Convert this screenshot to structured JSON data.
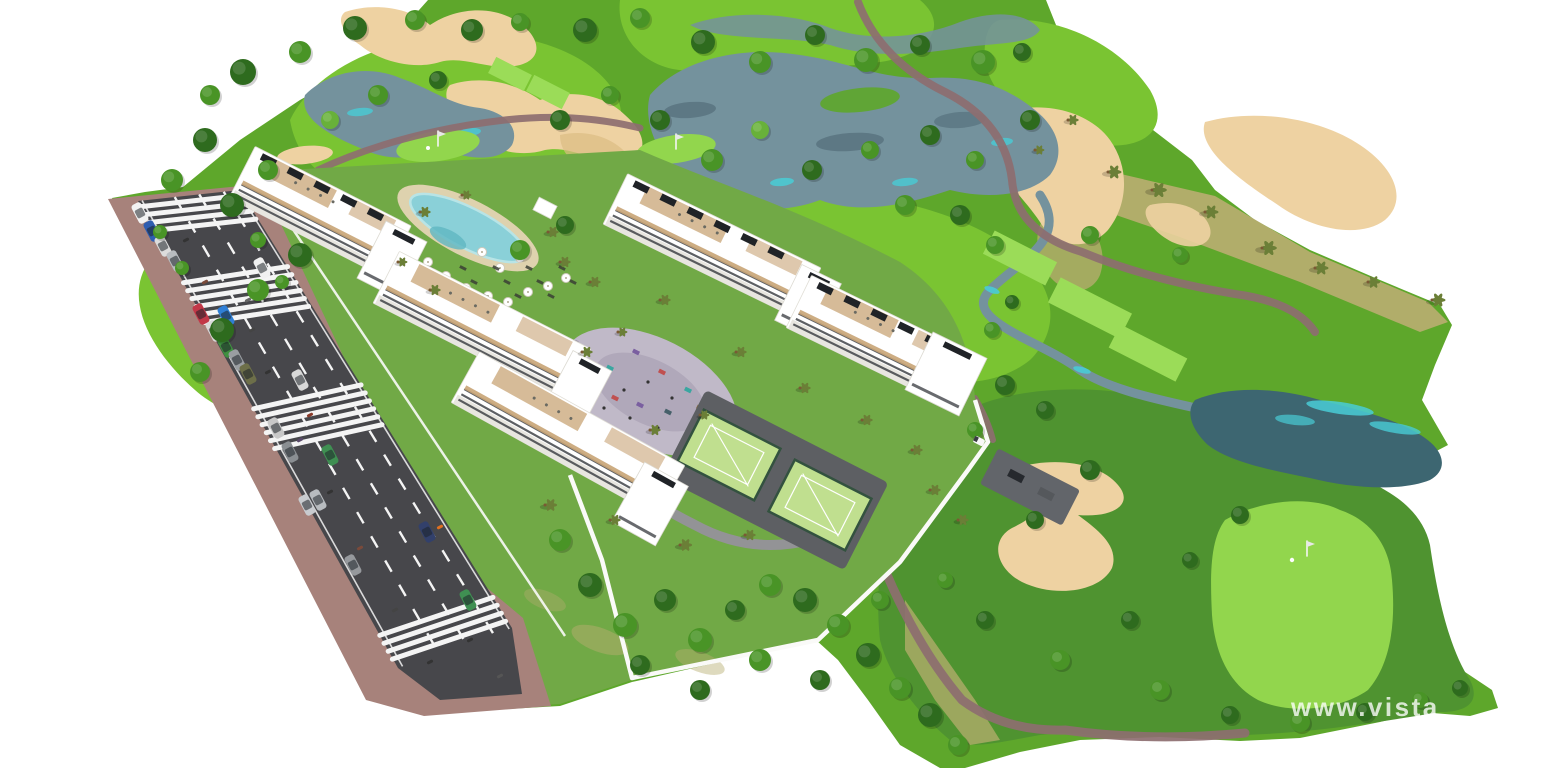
{
  "image": {
    "title": "Aerial 3D architectural render of a golf resort apartment development",
    "width": 1560,
    "height": 768
  },
  "watermark": {
    "text": "www.vistao",
    "color": "#ffffff",
    "opacity": 0.78
  },
  "palette": {
    "background": "#ffffff",
    "rough_green": "#5ea72b",
    "fairway_green": "#7ac432",
    "light_green": "#92d64d",
    "tee_green": "#9bdc58",
    "dark_lawn": "#4f9330",
    "garden_lawn": "#71a946",
    "scrub": "#b5ad6e",
    "sand": "#eed2a2",
    "sand_edge": "#dbbc83",
    "lake_blue": "#74929d",
    "lake_dark": "#57727e",
    "lake_teal": "#3d6671",
    "water_cyan": "#49ccd6",
    "cart_path": "#8d6e70",
    "road_asphalt": "#47474b",
    "road_marking": "#f4f4f4",
    "sidewalk_brick": "#a7827b",
    "building_white": "#ffffff",
    "building_shade": "#e8e6e0",
    "wood_deck": "#c8a476",
    "window_dark": "#35383d",
    "solar_panel": "#202327",
    "pool_water": "#8ad0d8",
    "pool_beach": "#ded2ae",
    "padel_court": "#c0df8f",
    "padel_fence": "#33523f",
    "playground_paving": "#c0b9c8",
    "tree_dark": "#2e6b1e",
    "tree_mid": "#499426",
    "tree_light": "#68b13a",
    "palm_frond": "#6b7f37",
    "wall_white": "#fafaf8"
  },
  "scene": {
    "features": [
      "golf-course",
      "fairways",
      "lakes",
      "stream",
      "sand-bunkers",
      "putting-greens",
      "tee-boxes",
      "cart-paths",
      "apartment-buildings",
      "roof-terraces",
      "swimming-pool",
      "pool-umbrellas",
      "sun-loungers",
      "playground",
      "padel-courts",
      "access-road",
      "parked-cars",
      "crosswalks",
      "sidewalks",
      "perimeter-walls",
      "palm-trees",
      "golf-flags",
      "golf-cart",
      "pedestrians",
      "watermark"
    ]
  }
}
